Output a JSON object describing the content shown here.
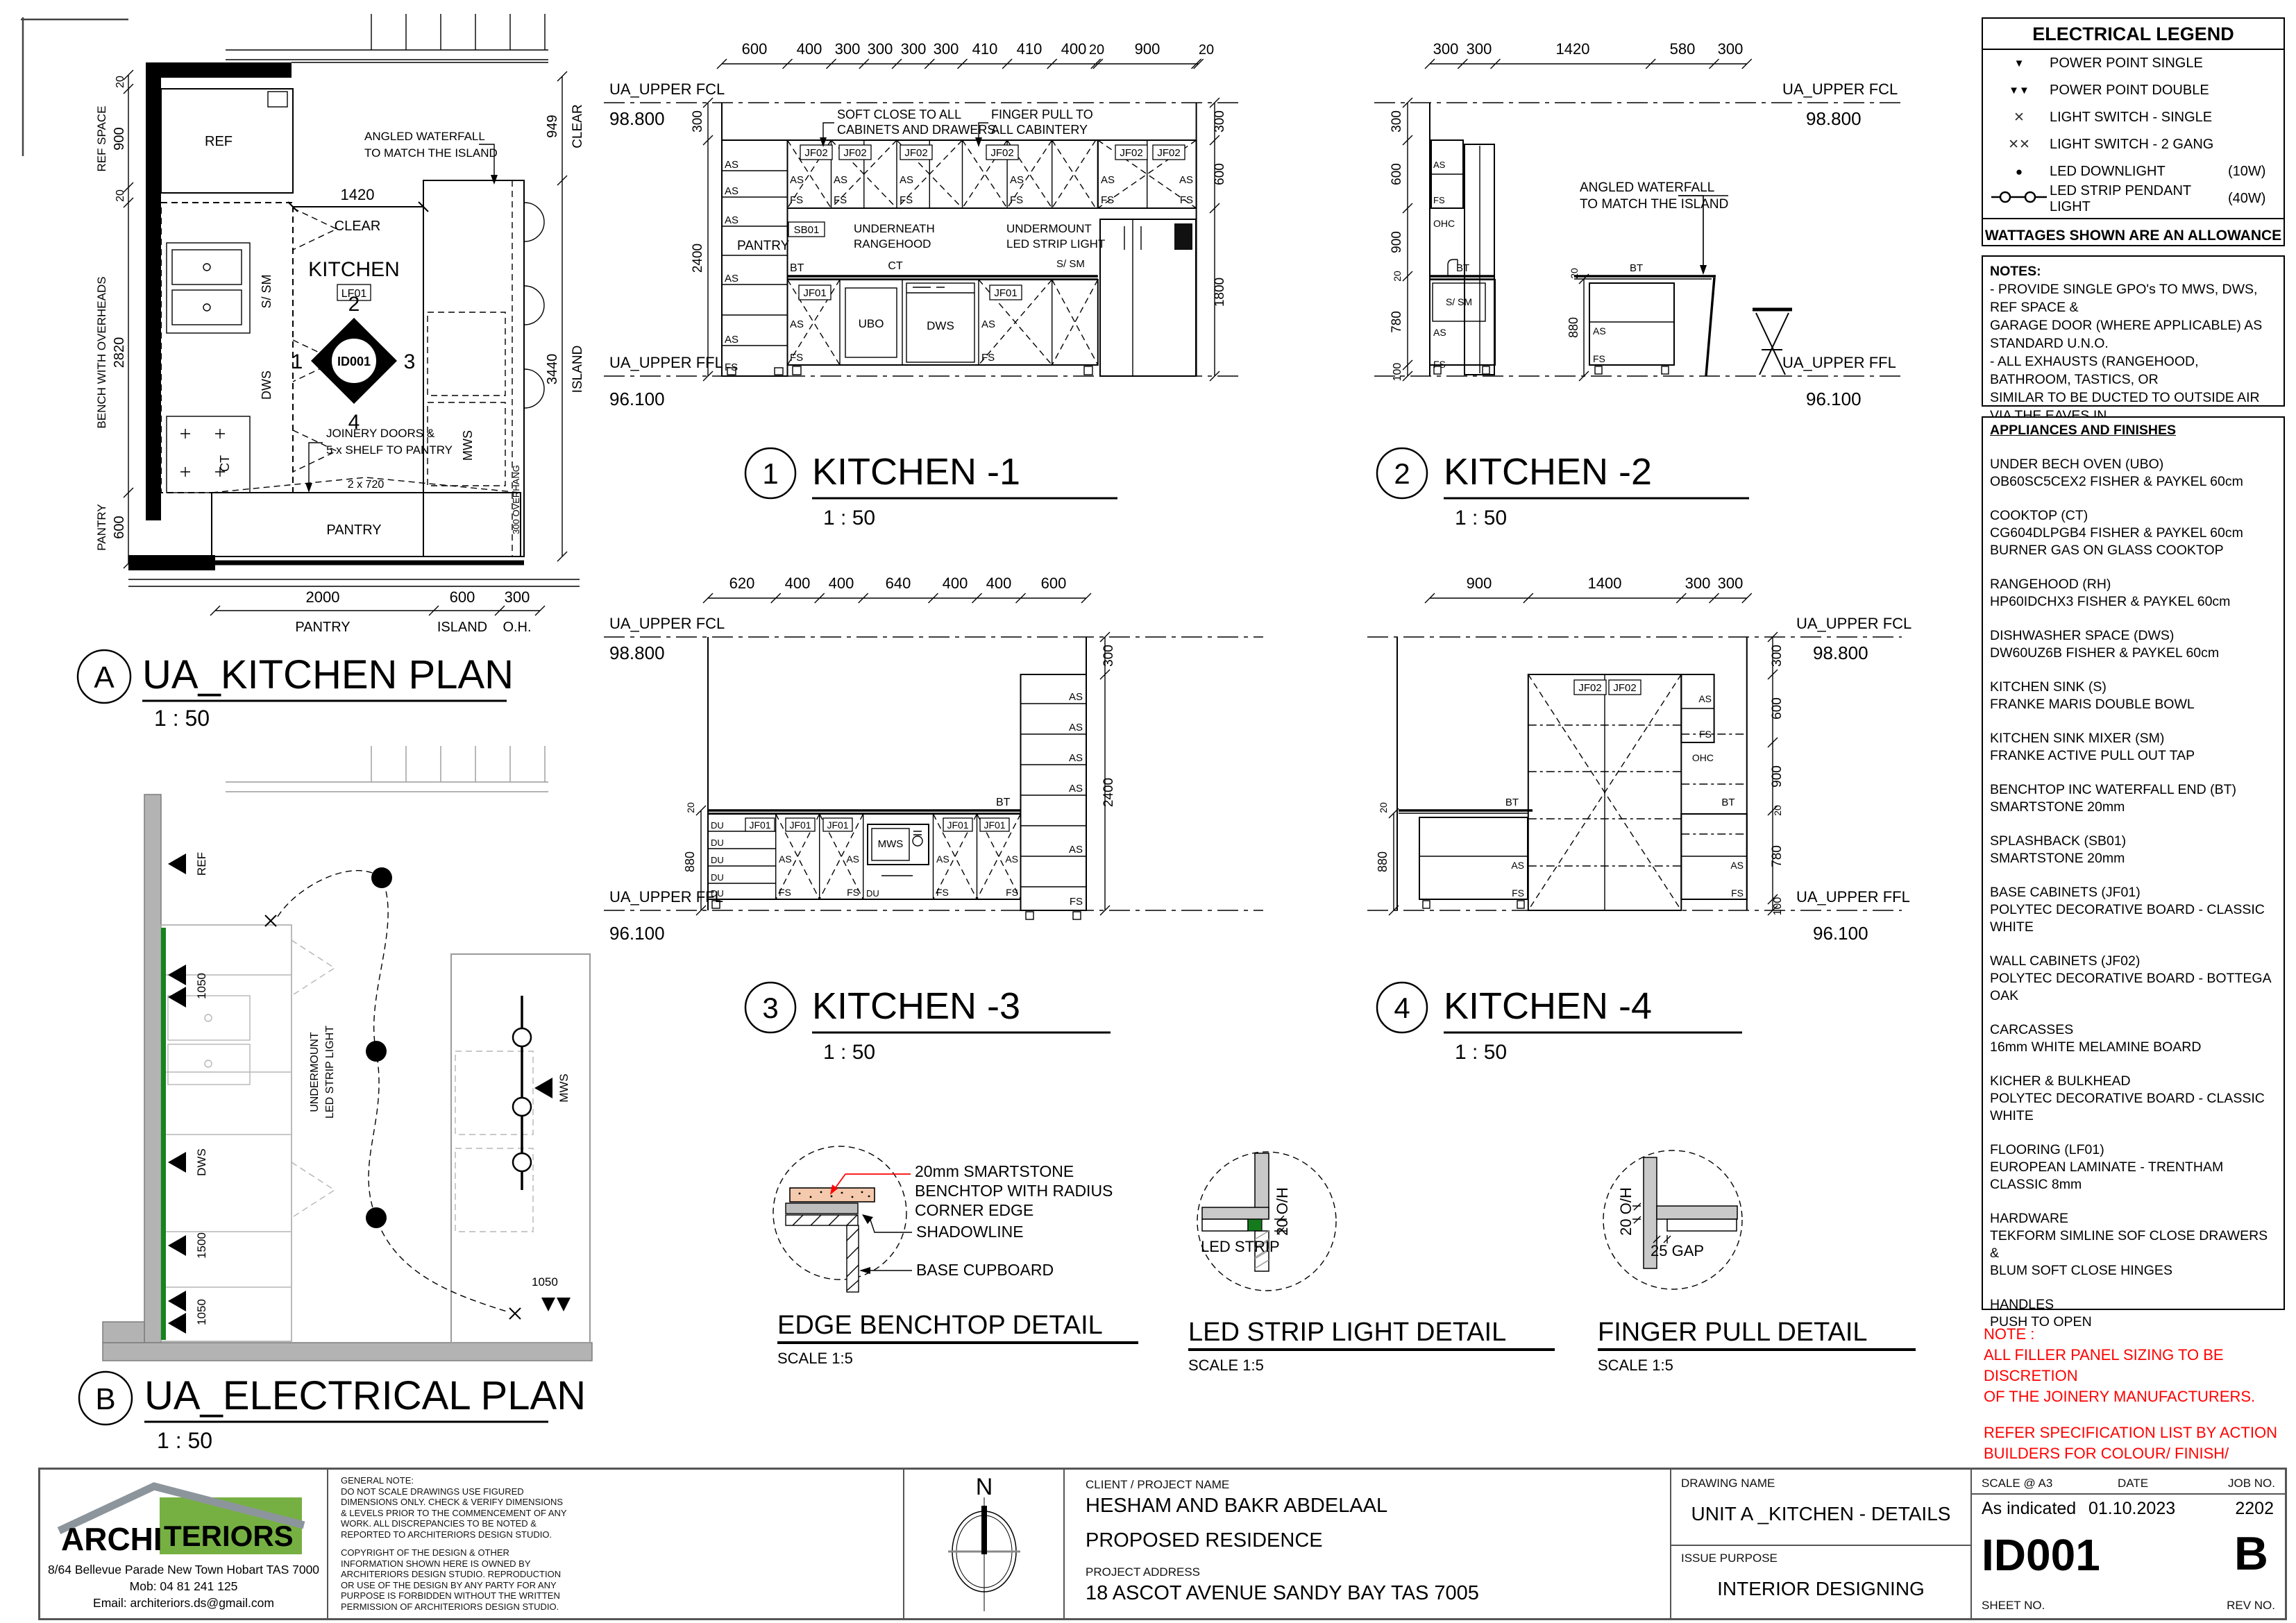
{
  "labels": {
    "as": "AS",
    "fs": "FS",
    "du": "DU",
    "bt": "BT",
    "ct": "CT",
    "ubo": "UBO",
    "dws": "DWS",
    "mws": "MWS",
    "ssm": "S/ SM",
    "ref": "REF",
    "ohc": "OHC",
    "sb01": "SB01",
    "jf01": "JF01",
    "jf02": "JF02",
    "pantry": "PANTRY",
    "kitchen": "KITCHEN",
    "lf01": "LF01",
    "id001": "ID001",
    "clear": "CLEAR",
    "island": "ISLAND",
    "oh": "O.H.",
    "overhang": "300 OVERHANG",
    "n": "N",
    "fcl": "UA_UPPER FCL",
    "ffl": "UA_UPPER FFL",
    "fcl_val": "98.800",
    "ffl_val": "96.100",
    "ref_space": "REF SPACE",
    "bench_oh": "BENCH WITH OVERHEADS",
    "soft1": "SOFT CLOSE TO ALL",
    "soft2": "CABINETS AND DRAWERS",
    "finger1": "FINGER PULL TO",
    "finger2": "ALL CABINTERY",
    "under1": "UNDERNEATH",
    "under2": "RANGEHOOD",
    "um1": "UNDERMOUNT",
    "um2": "LED STRIP LIGHT",
    "angled1": "ANGLED WATERFALL",
    "angled2": "TO MATCH THE ISLAND",
    "joinery1": "JOINERY DOORS &",
    "joinery2": "5 x SHELF TO PANTRY",
    "d720": "2 x 720"
  },
  "dims": {
    "20": "20",
    "100": "100",
    "300": "300",
    "400": "400",
    "410": "410",
    "580": "580",
    "600": "600",
    "620": "620",
    "640": "640",
    "780": "780",
    "880": "880",
    "900": "900",
    "949": "949",
    "1050": "1050",
    "1400": "1400",
    "1420": "1420",
    "1500": "1500",
    "1800": "1800",
    "2000": "2000",
    "2400": "2400",
    "2820": "2820",
    "3440": "3440"
  },
  "plans": {
    "a": {
      "ref": "A",
      "title": "UA_KITCHEN PLAN",
      "scale": "1 : 50"
    },
    "b": {
      "ref": "B",
      "title": "UA_ELECTRICAL PLAN",
      "scale": "1 : 50"
    }
  },
  "elevs": {
    "k1": {
      "num": "1",
      "title": "KITCHEN -1",
      "scale": "1 : 50"
    },
    "k2": {
      "num": "2",
      "title": "KITCHEN -2",
      "scale": "1 : 50"
    },
    "k3": {
      "num": "3",
      "title": "KITCHEN -3",
      "scale": "1 : 50"
    },
    "k4": {
      "num": "4",
      "title": "KITCHEN -4",
      "scale": "1 : 50"
    }
  },
  "details": {
    "d1": {
      "title": "EDGE BENCHTOP DETAIL",
      "scale": "SCALE 1:5",
      "note1": "20mm SMARTSTONE",
      "note2": "BENCHTOP WITH RADIUS",
      "note3": "CORNER EDGE",
      "shadowline": "SHADOWLINE",
      "base": "BASE CUPBOARD"
    },
    "d2": {
      "title": "LED STRIP LIGHT DETAIL",
      "scale": "SCALE 1:5",
      "led": "LED STRIP",
      "oh": "20 O/H"
    },
    "d3": {
      "title": "FINGER PULL DETAIL",
      "scale": "SCALE 1:5",
      "oh": "20 O/H",
      "gap": "25 GAP"
    }
  },
  "legend": {
    "title": "ELECTRICAL LEGEND",
    "items": [
      {
        "label": "POWER POINT SINGLE",
        "watt": ""
      },
      {
        "label": "POWER POINT DOUBLE",
        "watt": ""
      },
      {
        "label": "LIGHT SWITCH - SINGLE",
        "watt": ""
      },
      {
        "label": "LIGHT SWITCH - 2 GANG",
        "watt": ""
      },
      {
        "label": "LED DOWNLIGHT",
        "watt": "(10W)"
      },
      {
        "label": "LED STRIP PENDANT LIGHT",
        "watt": "(40W)"
      }
    ],
    "footer": "WATTAGES SHOWN ARE AN ALLOWANCE"
  },
  "notes": {
    "title": "NOTES:",
    "lines": [
      " - PROVIDE SINGLE GPO's TO MWS, DWS, REF SPACE &",
      "GARAGE DOOR (WHERE APPLICABLE) AS STANDARD U.N.O.",
      " - ALL EXHAUSTS (RANGEHOOD, BATHROOM, TASTICS, OR",
      "SIMILAR TO BE DUCTED TO OUTSIDE AIR VIA THE EAVES IN",
      "ACCORDANCE WITH NCC VOL 2, PART 3.8.7.3."
    ]
  },
  "appliances": {
    "title": "APPLIANCES AND FINISHES",
    "items": [
      {
        "name": "UNDER BECH OVEN (UBO)",
        "spec": "OB60SC5CEX2 FISHER & PAYKEL 60cm"
      },
      {
        "name": "COOKTOP (CT)",
        "spec": "CG604DLPGB4 FISHER & PAYKEL 60cm",
        "spec2": "BURNER GAS ON GLASS COOKTOP"
      },
      {
        "name": "RANGEHOOD (RH)",
        "spec": "HP60IDCHX3 FISHER & PAYKEL 60cm"
      },
      {
        "name": "DISHWASHER SPACE (DWS)",
        "spec": "DW60UZ6B FISHER & PAYKEL 60cm"
      },
      {
        "name": "KITCHEN SINK (S)",
        "spec": "FRANKE MARIS DOUBLE BOWL"
      },
      {
        "name": "KITCHEN SINK MIXER (SM)",
        "spec": "FRANKE ACTIVE PULL OUT TAP"
      },
      {
        "name": "BENCHTOP INC WATERFALL END (BT)",
        "spec": "SMARTSTONE 20mm"
      },
      {
        "name": "SPLASHBACK (SB01)",
        "spec": "SMARTSTONE 20mm"
      },
      {
        "name": "BASE CABINETS  (JF01)",
        "spec": "POLYTEC DECORATIVE BOARD - CLASSIC WHITE"
      },
      {
        "name": "WALL CABINETS (JF02)",
        "spec": "POLYTEC DECORATIVE BOARD - BOTTEGA OAK"
      },
      {
        "name": "CARCASSES",
        "spec": "16mm WHITE MELAMINE BOARD"
      },
      {
        "name": "KICHER & BULKHEAD",
        "spec": "POLYTEC DECORATIVE BOARD - CLASSIC WHITE"
      },
      {
        "name": "FLOORING (LF01)",
        "spec": "EUROPEAN LAMINATE - TRENTHAM CLASSIC 8mm"
      },
      {
        "name": "HARDWARE",
        "spec": "TEKFORM SIMLINE SOF CLOSE DRAWERS &",
        "spec2": "BLUM SOFT CLOSE HINGES"
      },
      {
        "name": "HANDLES",
        "spec": "PUSH TO OPEN"
      }
    ]
  },
  "red_note": {
    "lines": [
      "NOTE :",
      "ALL FILLER PANEL SIZING TO BE DISCRETION",
      "OF THE JOINERY MANUFACTURERS.",
      "",
      "REFER SPECIFICATION LIST BY ACTION",
      "BUILDERS FOR COLOUR/ FINISH/ SUPPLIER."
    ]
  },
  "tb": {
    "company": {
      "name1": "ARCHI",
      "name2": "TERIORS",
      "address": "8/64 Bellevue Parade New Town Hobart TAS 7000",
      "mob": "Mob:  04 81 241 125",
      "email": "Email: architeriors.ds@gmail.com"
    },
    "gn1": [
      "GENERAL NOTE:",
      "DO NOT SCALE DRAWINGS USE FIGURED",
      "DIMENSIONS ONLY. CHECK & VERIFY DIMENSIONS",
      "& LEVELS PRIOR TO THE COMMENCEMENT OF ANY",
      "WORK. ALL DISCREPANCIES TO BE NOTED &",
      "REPORTED TO ARCHITERIORS DESIGN STUDIO."
    ],
    "gn2": [
      "COPYRIGHT OF THE DESIGN & OTHER",
      "INFORMATION SHOWN HERE IS OWNED BY",
      "ARCHITERIORS DESIGN STUDIO. REPRODUCTION",
      "OR USE OF THE DESIGN BY ANY PARTY FOR ANY",
      "PURPOSE IS FORBIDDEN WITHOUT THE WRITTEN",
      "PERMISSION OF ARCHITERIORS DESIGN STUDIO."
    ],
    "client_label": "CLIENT / PROJECT NAME",
    "client_name": "HESHAM AND BAKR ABDELAAL",
    "project": "PROPOSED RESIDENCE",
    "address_label": "PROJECT ADDRESS",
    "address": "18 ASCOT AVENUE SANDY BAY TAS 7005",
    "drawing_label": "DRAWING NAME",
    "drawing_name": "UNIT A _KITCHEN - DETAILS",
    "issue_label": "ISSUE PURPOSE",
    "issue": "INTERIOR DESIGNING",
    "scale_label": "SCALE @ A3",
    "scale": "As indicated",
    "date_label": "DATE",
    "date": "01.10.2023",
    "job_label": "JOB NO.",
    "job": "2202",
    "sheet_label": "SHEET NO.",
    "sheet": "ID001",
    "rev_label": "REV NO.",
    "rev": "B"
  }
}
